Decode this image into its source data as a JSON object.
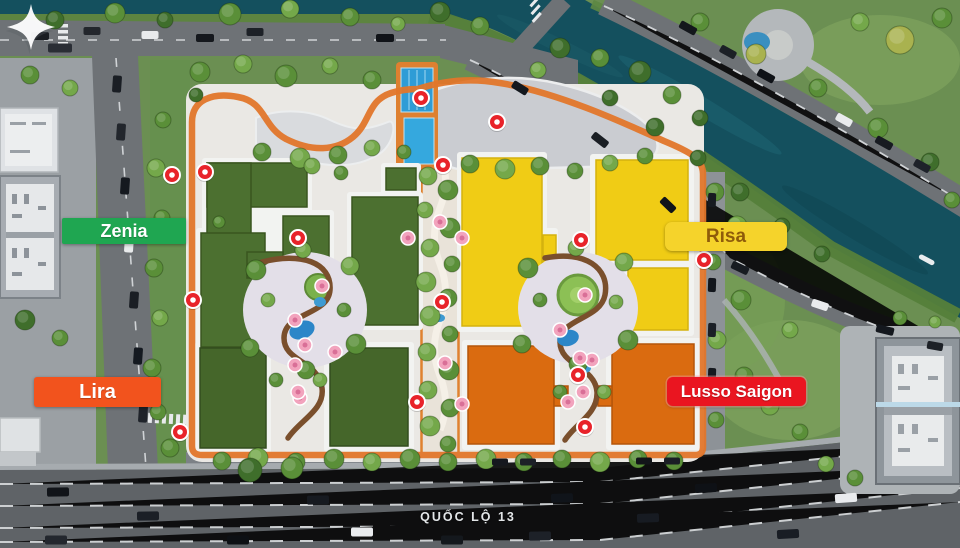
{
  "zones": {
    "zenia": {
      "label": "Zenia",
      "bg": "#1fa651",
      "text": "#ffffff",
      "roof": "#4c7030"
    },
    "risa": {
      "label": "Risa",
      "bg": "#f5d32b",
      "text": "#8f5c0a",
      "roof": "#f0cc15"
    },
    "lira": {
      "label": "Lira",
      "bg": "#f2531d",
      "text": "#ffffff",
      "roof": "#45662a"
    },
    "lusso": {
      "label": "Lusso Saigon",
      "bg": "#ea1520",
      "text": "#ffffff",
      "roof": "#da6b10"
    }
  },
  "roads": {
    "highway_label": "QUỐC LỘ 13"
  },
  "colors": {
    "river": "#14505e",
    "road": "#6e7276",
    "highway": "#5f6367",
    "ring_road": "#e2762a",
    "park": "#6b8f52",
    "pool": "#2e9cd6",
    "marker_red": "#e8232a",
    "marker_pink": "#f2a3bd",
    "courtyard": "#e3dfe8",
    "plaza": "#b4b8bb",
    "site_base": "#eae8e4"
  },
  "watermark": {
    "icon": "compass-star"
  }
}
